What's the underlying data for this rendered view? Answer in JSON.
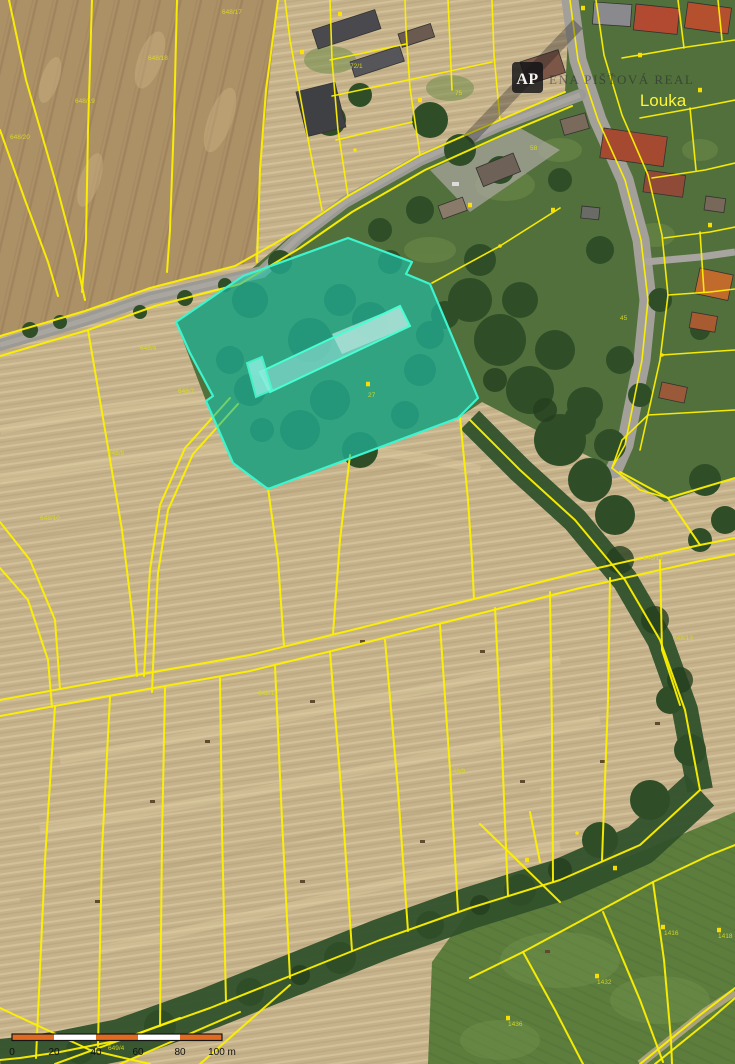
{
  "map": {
    "place_label": "Louka",
    "watermark": {
      "logo": "AP",
      "text": "ENA PIŠŤOVÁ REAL"
    },
    "colors": {
      "cadastral_boundary": "#fdf000",
      "highlight_fill": "#1fc4ab",
      "highlight_outline": "#3cf5cf",
      "scale_bar_orange": "#e06a20",
      "scale_bar_white": "#ffffff"
    },
    "highlighted_parcel": {
      "note_symbol": "building-symbol"
    },
    "parcel_labels": [
      {
        "x": 75,
        "y": 103,
        "text": "648/19"
      },
      {
        "x": 10,
        "y": 139,
        "text": "648/20"
      },
      {
        "x": 148,
        "y": 60,
        "text": "648/18"
      },
      {
        "x": 222,
        "y": 14,
        "text": "648/17"
      },
      {
        "x": 108,
        "y": 455,
        "text": "648/8"
      },
      {
        "x": 140,
        "y": 350,
        "text": "648/4"
      },
      {
        "x": 40,
        "y": 520,
        "text": "648/10"
      },
      {
        "x": 178,
        "y": 393,
        "text": "648/7"
      },
      {
        "x": 449,
        "y": 773,
        "text": "648/9"
      },
      {
        "x": 258,
        "y": 695,
        "text": "648/11"
      },
      {
        "x": 643,
        "y": 560,
        "text": "648/12"
      },
      {
        "x": 673,
        "y": 640,
        "text": "648/13"
      },
      {
        "x": 597,
        "y": 984,
        "text": "1432"
      },
      {
        "x": 664,
        "y": 935,
        "text": "1416"
      },
      {
        "x": 718,
        "y": 938,
        "text": "1418"
      },
      {
        "x": 508,
        "y": 1026,
        "text": "1436"
      },
      {
        "x": 108,
        "y": 1050,
        "text": "649/4"
      },
      {
        "x": 368,
        "y": 397,
        "text": "27"
      },
      {
        "x": 350,
        "y": 68,
        "text": "72/1"
      },
      {
        "x": 455,
        "y": 95,
        "text": "75"
      },
      {
        "x": 530,
        "y": 150,
        "text": "58"
      },
      {
        "x": 620,
        "y": 320,
        "text": "45"
      }
    ],
    "symbols": [
      {
        "x": 368,
        "y": 384,
        "shape": "square"
      },
      {
        "x": 597,
        "y": 976,
        "shape": "square"
      },
      {
        "x": 663,
        "y": 927,
        "shape": "square"
      },
      {
        "x": 719,
        "y": 930,
        "shape": "square"
      },
      {
        "x": 508,
        "y": 1018,
        "shape": "square"
      },
      {
        "x": 527,
        "y": 860,
        "shape": "square"
      },
      {
        "x": 615,
        "y": 868,
        "shape": "square"
      },
      {
        "x": 302,
        "y": 52,
        "shape": "square"
      },
      {
        "x": 420,
        "y": 100,
        "shape": "square"
      },
      {
        "x": 470,
        "y": 205,
        "shape": "square"
      },
      {
        "x": 553,
        "y": 210,
        "shape": "square"
      },
      {
        "x": 640,
        "y": 55,
        "shape": "square"
      },
      {
        "x": 700,
        "y": 90,
        "shape": "square"
      },
      {
        "x": 340,
        "y": 14,
        "shape": "square"
      },
      {
        "x": 583,
        "y": 8,
        "shape": "square"
      },
      {
        "x": 710,
        "y": 225,
        "shape": "square"
      },
      {
        "x": 577,
        "y": 833,
        "shape": "dot"
      },
      {
        "x": 355,
        "y": 150,
        "shape": "dot"
      },
      {
        "x": 500,
        "y": 246,
        "shape": "dot"
      },
      {
        "x": 662,
        "y": 355,
        "shape": "dot"
      }
    ],
    "scale_bar": {
      "x": 12,
      "y": 1034,
      "width": 210,
      "height": 6.5,
      "segments": 5,
      "labels": [
        "0",
        "20",
        "40",
        "60",
        "80",
        "100 m"
      ]
    }
  }
}
